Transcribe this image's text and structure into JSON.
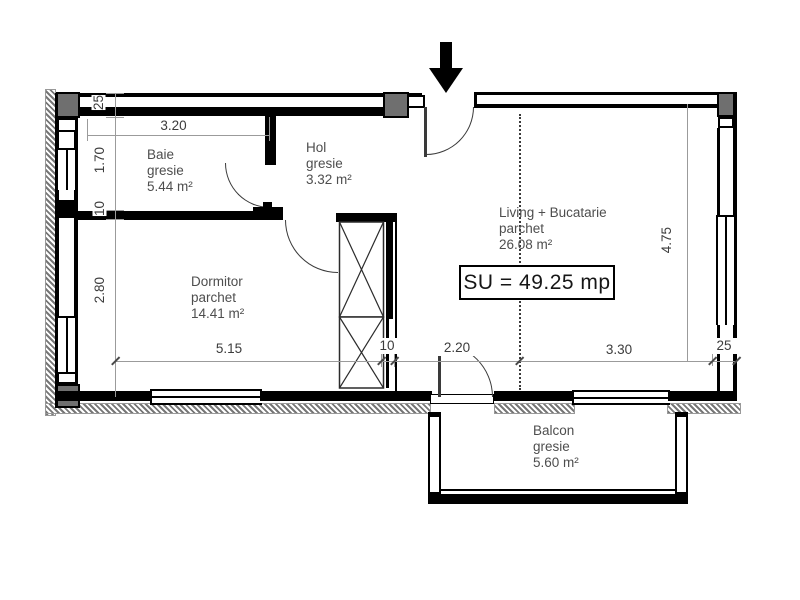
{
  "rooms": {
    "baie": {
      "name": "Baie",
      "finish": "gresie",
      "area": "5.44 m²"
    },
    "hol": {
      "name": "Hol",
      "finish": "gresie",
      "area": "3.32 m²"
    },
    "dormitor": {
      "name": "Dormitor",
      "finish": "parchet",
      "area": "14.41 m²"
    },
    "living": {
      "name": "Living + Bucatarie",
      "finish": "parchet",
      "area": "26.08 m²"
    },
    "balcon": {
      "name": "Balcon",
      "finish": "gresie",
      "area": "5.60 m²"
    }
  },
  "total_area_label": "SU = 49.25 mp",
  "dims": {
    "baie_width": "3.20",
    "top_wall_thickness": "25",
    "baie_height": "1.70",
    "partition_thickness": "10",
    "dormitor_height": "2.80",
    "dormitor_width": "5.15",
    "shaft_wall_thickness": "10",
    "balcony_door_width": "2.20",
    "living_width": "3.30",
    "right_wall_thickness": "25",
    "living_height": "4.75"
  },
  "colors": {
    "wall": "#000000",
    "pillar": "#6f6f6f",
    "dim": "#9b9b9b",
    "dimtext": "#3c3c3c",
    "roomtext": "#4e4e4e"
  }
}
